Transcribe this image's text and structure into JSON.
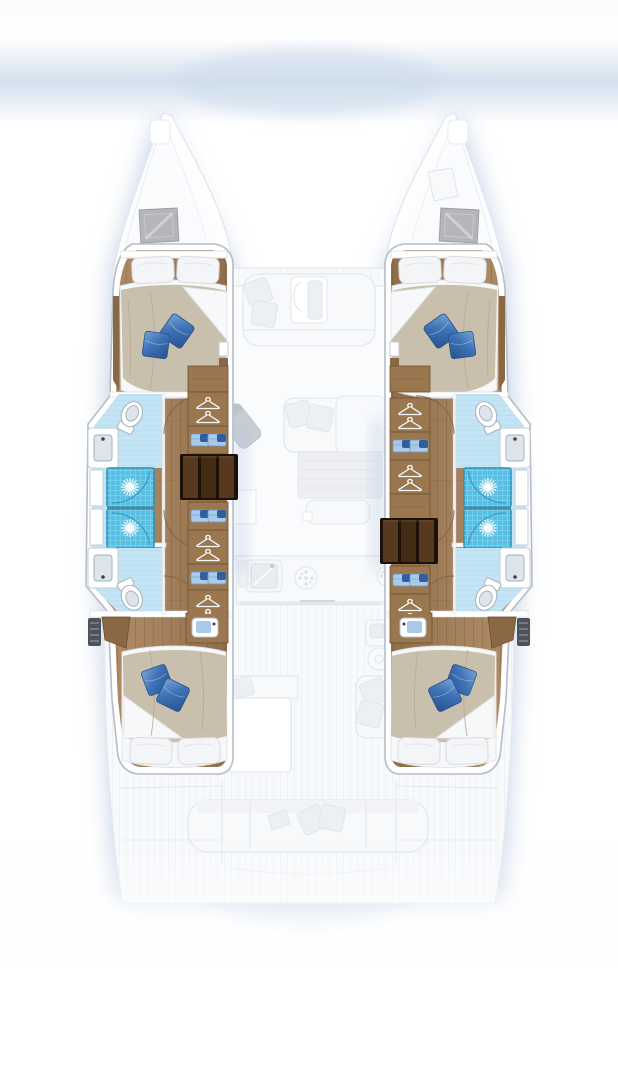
{
  "meta": {
    "title": "Catamaran interior layout plan (top view)",
    "description": "Top-down arrangement drawing of a 4-cabin / 4-head sailing catamaran: colored lower-deck hull interiors over a ghosted main deck",
    "orientation": "bow at top, stern at bottom"
  },
  "palette": {
    "glow": "#b6c8e2",
    "sky_band": "#cedcec",
    "ghost_line": "#e3e7ed",
    "ghost_fill": "#f7f9fb",
    "ghost_fill2": "#eceff3",
    "ghost_table": "#edeff3",
    "nav_gray": "#c9cdd4",
    "hatch": "#b4b6b9",
    "frame": "#b6bcc5",
    "wood": "#a5825e",
    "wood_dark": "#8a6844",
    "wood_line": "#5f3f22",
    "wardrobe": "#9a774f",
    "stair_bg": "#1d1107",
    "stair_a": "#56391f",
    "stair_b": "#432c14",
    "sheet": "#f7f8f9",
    "duvet": "#c9bfad",
    "duvet_shadow": "#b3a890",
    "pillow": "#f4f5f7",
    "pillow_edge": "#d8dbe0",
    "bpillow": "#3e72b6",
    "bpillow_dark": "#27538e",
    "bpillow_light": "#7aa3d6",
    "bath": "#c3e4f4",
    "bath_line": "#9cc9e0",
    "shower": "#55c0e3",
    "shower_dark": "#2b8fb6",
    "fixture_edge": "#a9b6bf",
    "basin": "#dde5ea",
    "faucet": "#3c4147",
    "towel": "#a9cae9",
    "towel_dark": "#2f5f9e",
    "vent": "#4d5359",
    "arc": "#7a6248",
    "arc_blue": "#2d7fa3"
  },
  "vessel": {
    "type": "sailing catamaran floor plan",
    "upper_deck_ghosted": {
      "areas": [
        "port bow with deck hatch",
        "starboard bow with deck hatch",
        "foredeck",
        "forward cockpit bench with table and cushions",
        "salon: sofa with throw cushions, coffee table, bench seat, navigation seat, chart table",
        "galley: sink, two burner rings, counters",
        "aft cockpit: table, side seat with cushions, helm seat, cockpit sink",
        "aft bench with cushions",
        "port swim platform",
        "starboard swim platform"
      ]
    },
    "port_hull": {
      "rooms": [
        {
          "name": "forward cabin",
          "furniture": [
            "double bed",
            "2 white pillows",
            "beige duvet with turned sheet",
            "2 blue throw pillows",
            "wood flooring"
          ]
        },
        {
          "name": "forward head",
          "furniture": [
            "toilet",
            "washbasin with faucet",
            "door swing"
          ]
        },
        {
          "name": "shower stalls",
          "count": 2,
          "furniture": [
            "rain shower heads",
            "glass door arcs"
          ]
        },
        {
          "name": "aft head",
          "furniture": [
            "toilet",
            "washbasin with faucet",
            "door swing"
          ]
        },
        {
          "name": "aft cabin",
          "furniture": [
            "double bed",
            "2 white pillows",
            "beige duvet",
            "2 blue throw pillows",
            "vanity with basin",
            "louvered vent",
            "corner bench"
          ]
        },
        {
          "name": "wardrobe strip",
          "furniture": [
            "hanging lockers",
            "towel shelves"
          ]
        },
        {
          "name": "companionway stairs",
          "treads": 3
        }
      ]
    },
    "starboard_hull": {
      "mirrored_from": "port_hull",
      "rooms": [
        {
          "name": "forward cabin"
        },
        {
          "name": "forward head"
        },
        {
          "name": "shower stalls",
          "count": 2
        },
        {
          "name": "aft head"
        },
        {
          "name": "aft cabin"
        },
        {
          "name": "wardrobe strip"
        },
        {
          "name": "companionway stairs",
          "treads": 3
        }
      ]
    }
  }
}
